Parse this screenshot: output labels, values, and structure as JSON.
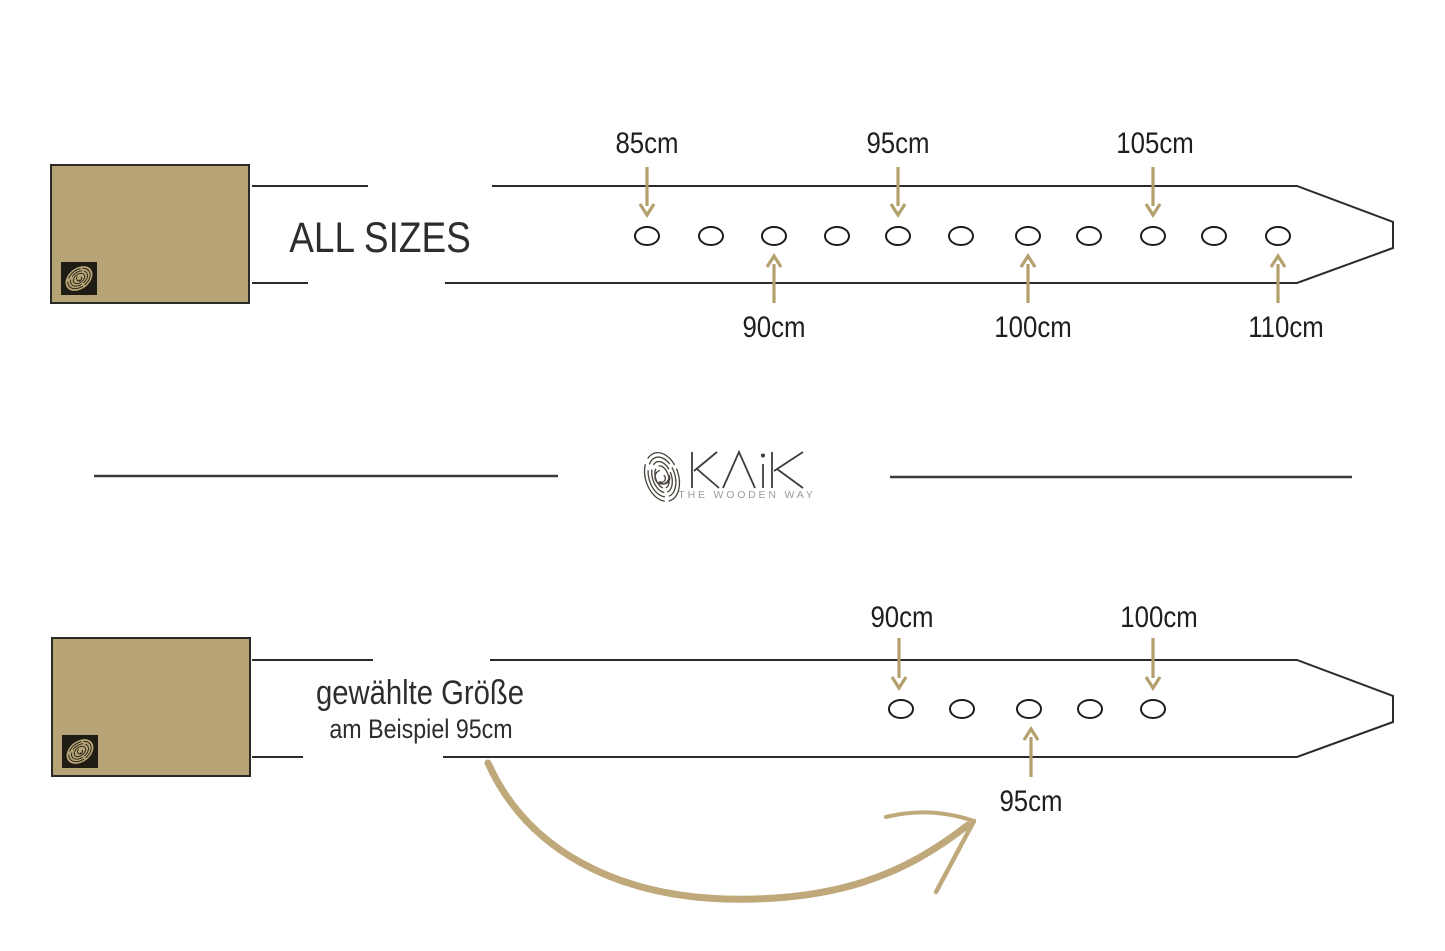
{
  "brand": {
    "name": "KAiK",
    "tagline": "THE WOODEN WAY"
  },
  "colors": {
    "accent_tan": "#b3a06c",
    "sketch_arrow_tan": "#bfa87a",
    "buckle_tan": "#b7a476",
    "ink": "#2b2b28",
    "text": "#1f1f1f",
    "muted_text": "#9b9b9b"
  },
  "top_diagram": {
    "title": "ALL SIZES",
    "sizes_cm": [
      85,
      90,
      95,
      100,
      105,
      110
    ],
    "labels_above": [
      "85cm",
      "95cm",
      "105cm"
    ],
    "labels_below": [
      "90cm",
      "100cm",
      "110cm"
    ],
    "hole_count": 11,
    "hole_positions_x": [
      647,
      711,
      774,
      837,
      898,
      961,
      1028,
      1089,
      1153,
      1214,
      1278
    ],
    "hole_center_y": 236
  },
  "bottom_diagram": {
    "title": "gewählte Größe",
    "subtitle": "am Beispiel 95cm",
    "example_size_cm": 95,
    "labels_above": [
      "90cm",
      "100cm"
    ],
    "label_below": "95cm",
    "hole_count": 5,
    "hole_positions_x": [
      901,
      962,
      1029,
      1090,
      1153
    ],
    "hole_center_y": 709
  }
}
